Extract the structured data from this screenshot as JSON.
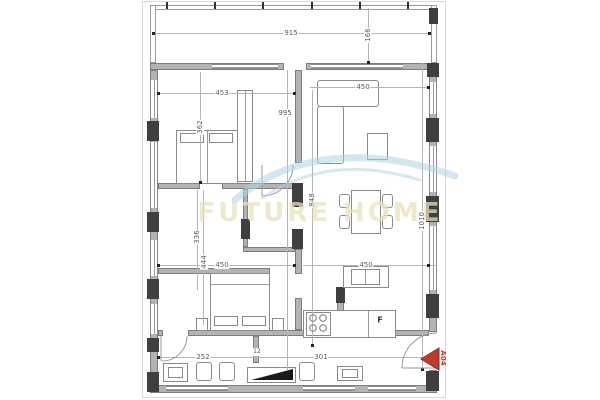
{
  "watermark": {
    "text": "FUTURE HOME"
  },
  "entrance": {
    "label": "A04"
  },
  "kitchen": {
    "fridge_label": "F"
  },
  "dims": {
    "terrace_width": "915",
    "terrace_depth": "166",
    "bedroom1_width": "453",
    "bedroom1_height": "362",
    "interior_height": "995",
    "living_width": "450",
    "living_height": "848",
    "right_height": "1010",
    "room2_height_a": "336",
    "room2_height_b": "444",
    "room2_width": "450",
    "kitchen_width": "450",
    "hall_a": "252",
    "hall_b": "12",
    "hall_c": "301"
  },
  "colors": {
    "wall": "#b3b3b3",
    "column": "#3f3f3f",
    "dimension_line": "#b5b5b5",
    "accent_red": "#c0392b",
    "watermark_blue": "#aed3e6",
    "watermark_text": "#e8e1b9"
  }
}
